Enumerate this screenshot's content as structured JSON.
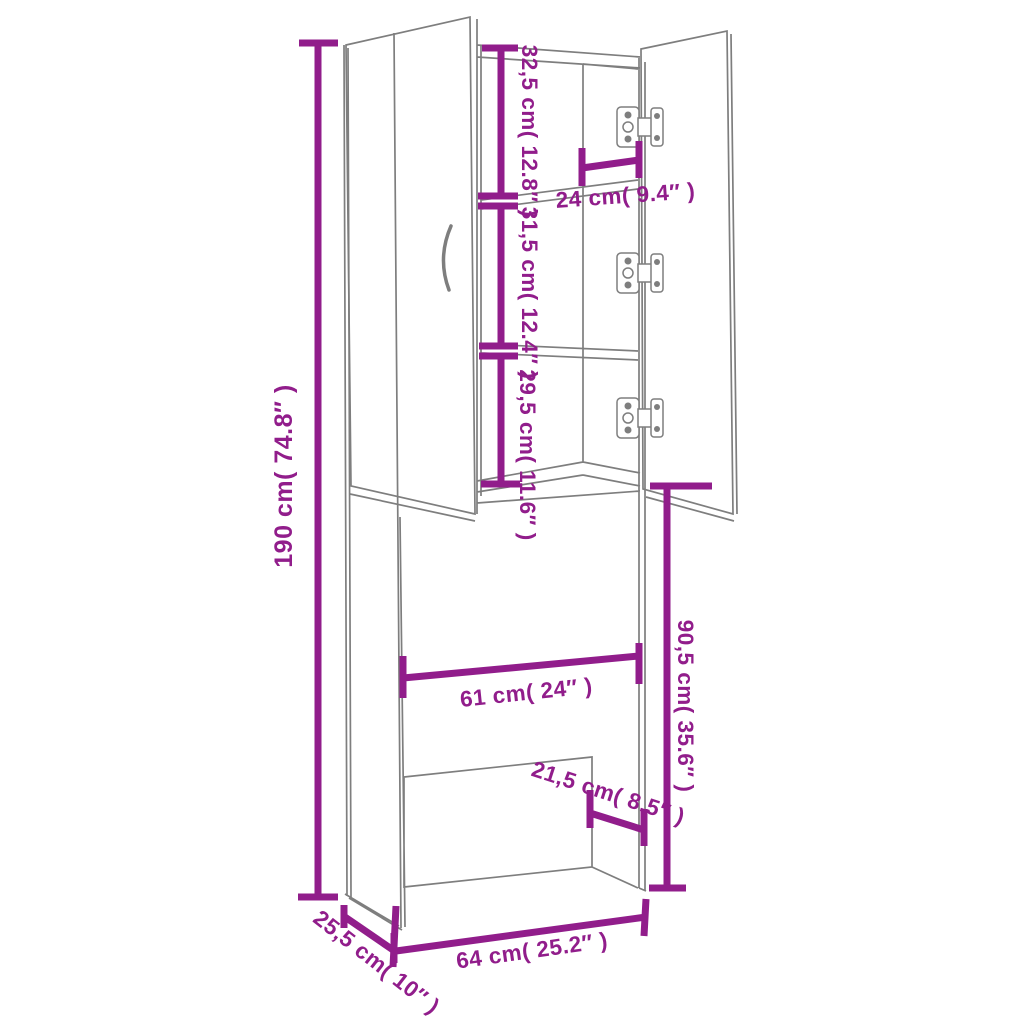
{
  "diagram": {
    "background": "#ffffff",
    "accent_color": "#911d8b",
    "outline_color": "#7e7e7e",
    "dims": {
      "total_height": "190 cm( 74.8″ )",
      "top_section": "32,5 cm( 12.8″ )",
      "middle_section": "31,5 cm( 12.4″ )",
      "lower_section": "29,5 cm( 11.6″ )",
      "top_inner_width": "24 cm( 9.4″ )",
      "opening_height": "90,5 cm( 35.6″ )",
      "opening_width": "61 cm( 24″ )",
      "back_panel_height": "21,5 cm( 8.5″ )",
      "total_width": "64 cm( 25.2″ )",
      "total_depth": "25,5 cm( 10″ )"
    }
  }
}
